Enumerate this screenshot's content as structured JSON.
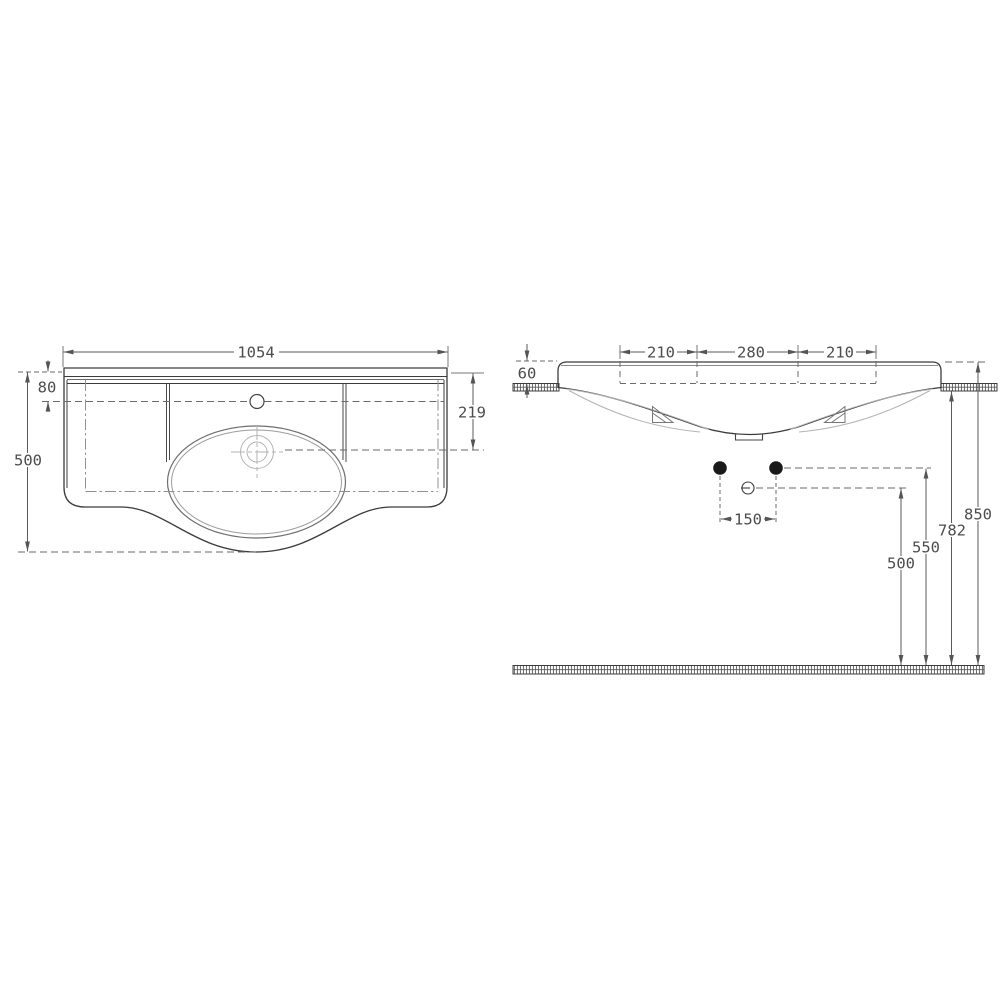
{
  "colors": {
    "paper": "#ffffff",
    "object_line": "#3c3c3c",
    "dim_line": "#5a5a5a",
    "hidden_line": "#909090",
    "light_line": "#b3b3b3",
    "text": "#4c4c4c"
  },
  "plan_view": {
    "dims": {
      "overall_width": "1054",
      "back_rail_depth": "80",
      "overall_depth": "500",
      "bowl_centre_from_back": "219"
    }
  },
  "side_view": {
    "dims": {
      "span_left": "210",
      "span_centre": "280",
      "span_right": "210",
      "front_edge_height": "60",
      "fixing_hole_spacing": "150",
      "height_top_edge": "850",
      "height_underside": "782",
      "height_fixing_holes": "550",
      "height_waste_outlet": "500"
    }
  }
}
